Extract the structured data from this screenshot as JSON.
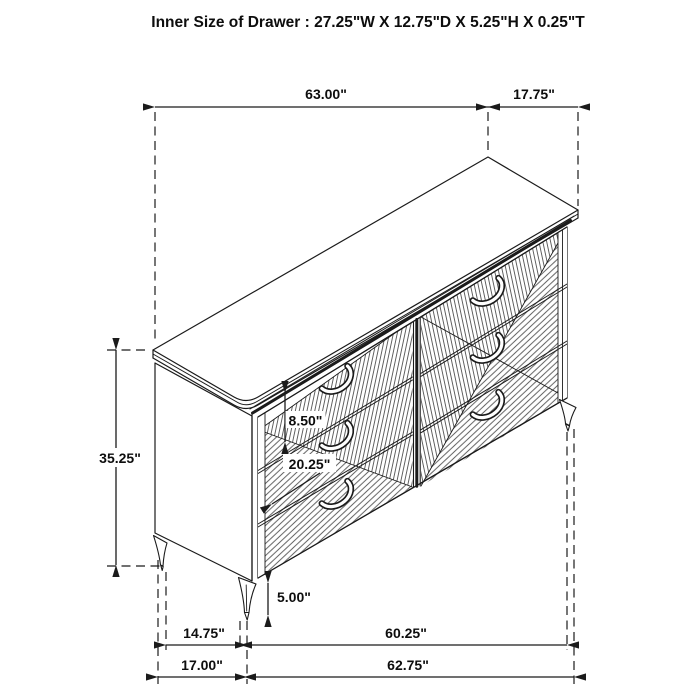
{
  "title": "Inner Size of Drawer : 27.25\"W X 12.75\"D X 5.25\"H X 0.25\"T",
  "dimensions": {
    "top_length": "63.00\"",
    "top_depth": "17.75\"",
    "overall_height": "35.25\"",
    "drawer_face_height": "8.50\"",
    "drawer_width": "20.25\"",
    "leg_height": "5.00\"",
    "base_depth": "14.75\"",
    "base_width": "60.25\"",
    "floor_depth": "17.00\"",
    "floor_width": "62.75\""
  }
}
